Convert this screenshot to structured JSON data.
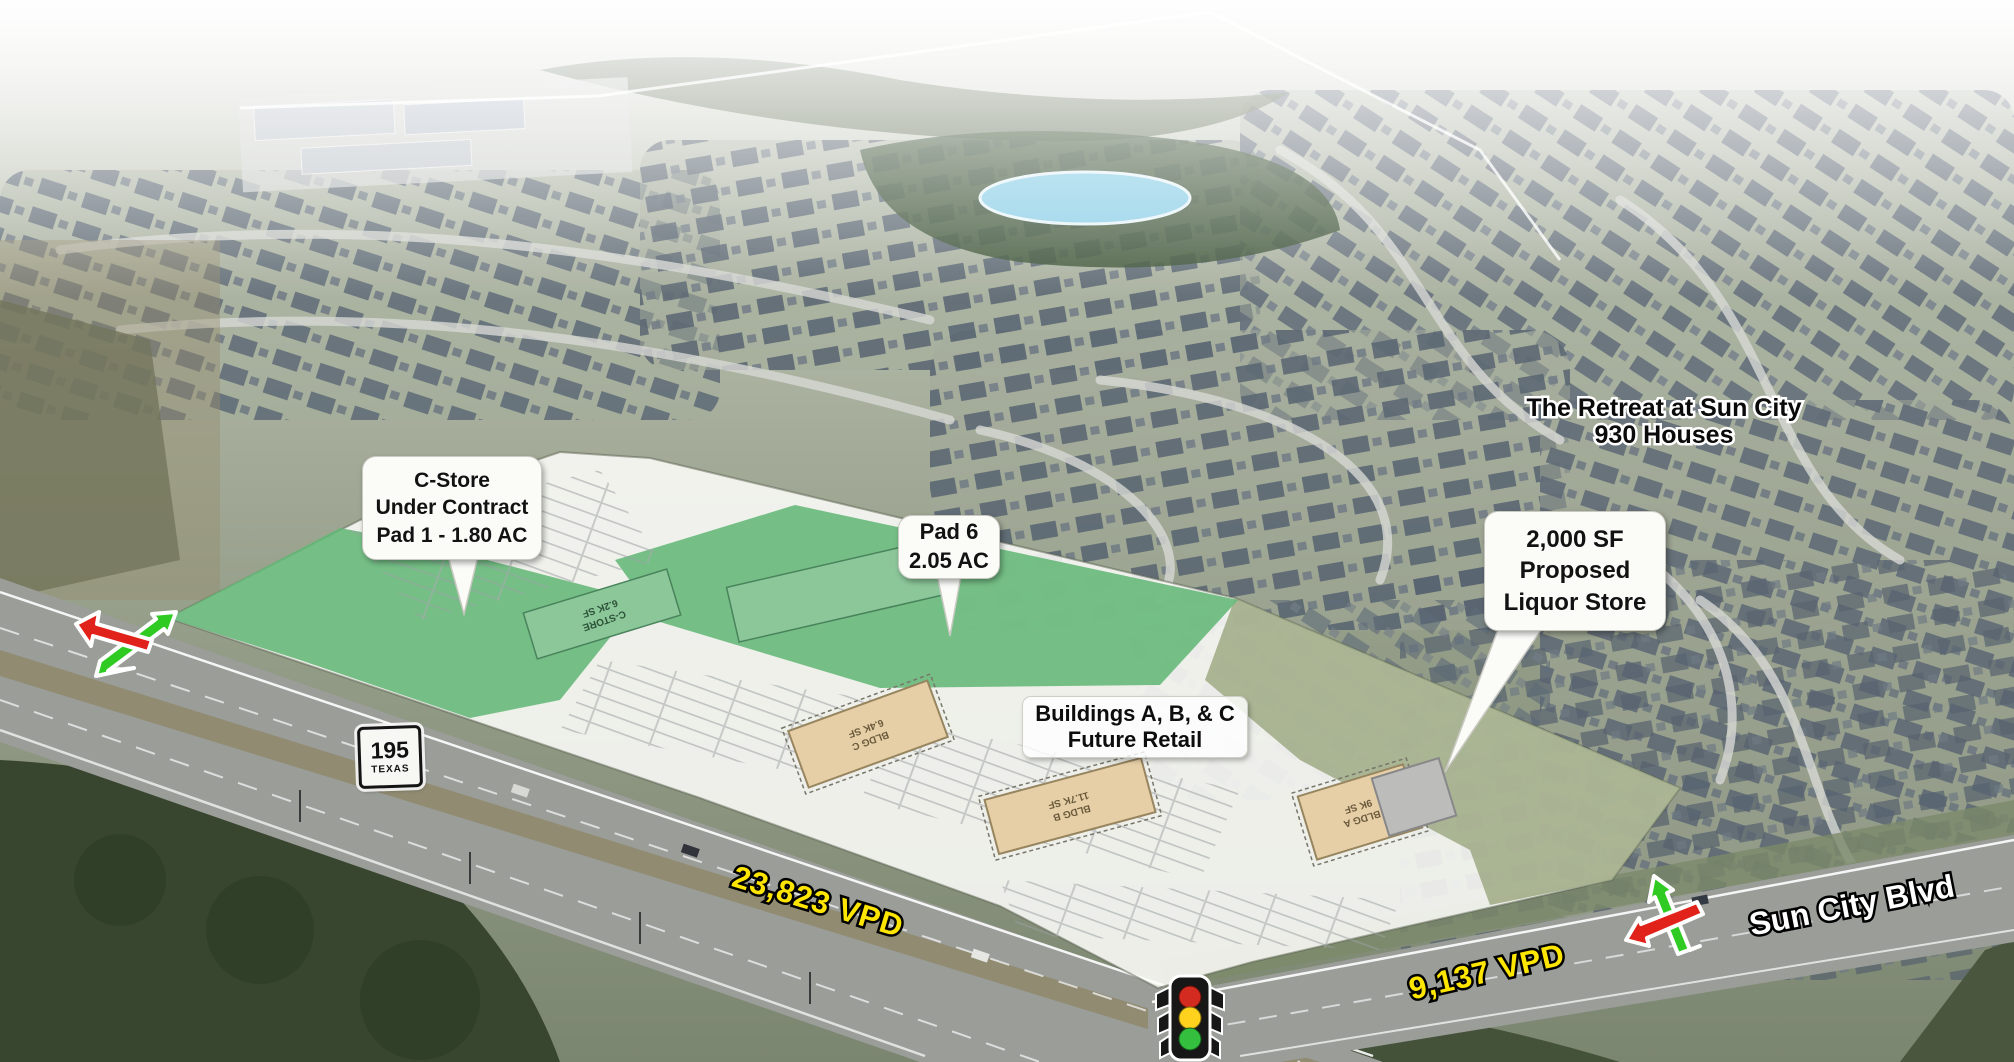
{
  "callouts": {
    "c_store": {
      "line1": "C-Store",
      "line2": "Under Contract",
      "line3": "Pad 1 - 1.80 AC"
    },
    "pad6": {
      "line1": "Pad 6",
      "line2": "2.05 AC"
    },
    "liquor": {
      "line1": "2,000 SF",
      "line2": "Proposed",
      "line3": "Liquor Store"
    },
    "buildings_abc": {
      "line1": "Buildings A, B, & C",
      "line2": "Future Retail"
    },
    "retreat": {
      "line1": "The Retreat at Sun City",
      "line2": "930 Houses"
    }
  },
  "roads": {
    "shield": {
      "route": "195",
      "state": "TEXAS"
    },
    "highway_vpd": "23,823 VPD",
    "blvd_vpd": "9,137 VPD",
    "blvd_name": "Sun City Blvd"
  },
  "site_plan": {
    "pads": [
      {
        "label": "C-STORE",
        "size": "6.2K SF"
      },
      {
        "label": "BLDG C",
        "size": "6.4K SF"
      },
      {
        "label": "BLDG B",
        "size": "11.7K SF"
      },
      {
        "label": "BLDG A",
        "size": "9K SF"
      }
    ]
  },
  "icons": {
    "traffic_light": "traffic-light-icon",
    "turn_arrows_left": "red-green-turn-arrows",
    "turn_arrows_right": "red-green-turn-arrows"
  },
  "colors": {
    "pad_green": "#64b878",
    "pad_green_dark": "#8cc79a",
    "olive_overlay": "#93a077",
    "bldg_tan": "#e6cfa6",
    "liquor_gray": "#bcbcba",
    "vpd_yellow": "#ffe600",
    "arrow_red": "#e0221a",
    "arrow_green": "#2fcb22",
    "signal_red": "#d32b1f",
    "signal_yellow": "#ffd21e",
    "signal_green": "#35bf3f"
  }
}
